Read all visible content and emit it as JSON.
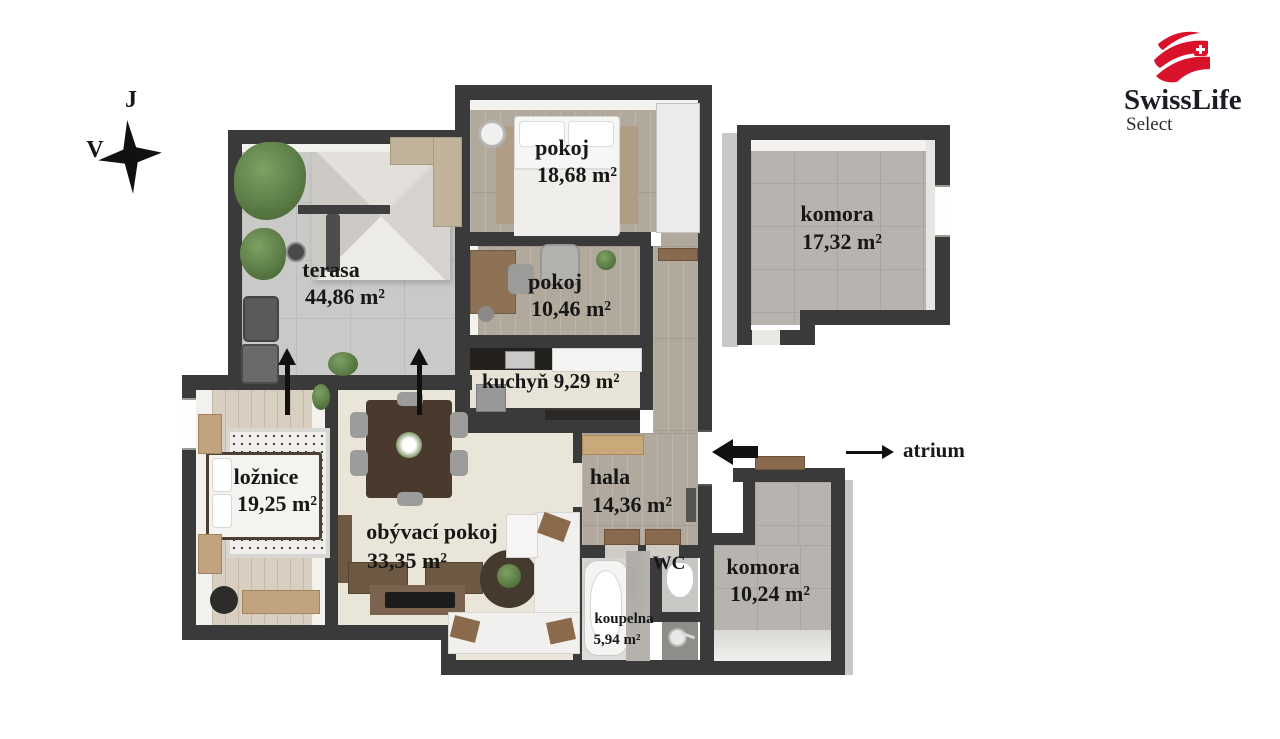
{
  "compass": {
    "south": "J",
    "east": "V"
  },
  "logo": {
    "brand": "SwissLife",
    "sub": "Select"
  },
  "rooms": {
    "pokoj1": {
      "name": "pokoj",
      "area": "18,68 m²"
    },
    "pokoj2": {
      "name": "pokoj",
      "area": "10,46 m²"
    },
    "kuchyn": {
      "name": "kuchyň",
      "area": "9,29 m²"
    },
    "terasa": {
      "name": "terasa",
      "area": "44,86 m²"
    },
    "loznice": {
      "name": "ložnice",
      "area": "19,25 m²"
    },
    "obyvaci": {
      "name": "obývací pokoj",
      "area": "33,35 m²"
    },
    "hala": {
      "name": "hala",
      "area": "14,36 m²"
    },
    "wc": {
      "name": "WC",
      "area": ""
    },
    "koupelna": {
      "name": "koupelna",
      "area": "5,94 m²"
    },
    "komora1": {
      "name": "komora",
      "area": "17,32 m²"
    },
    "komora2": {
      "name": "komora",
      "area": "10,24 m²"
    }
  },
  "annotations": {
    "atrium": "atrium"
  },
  "colors": {
    "wall": "#3a3a3a",
    "brand_red": "#d9122c"
  }
}
